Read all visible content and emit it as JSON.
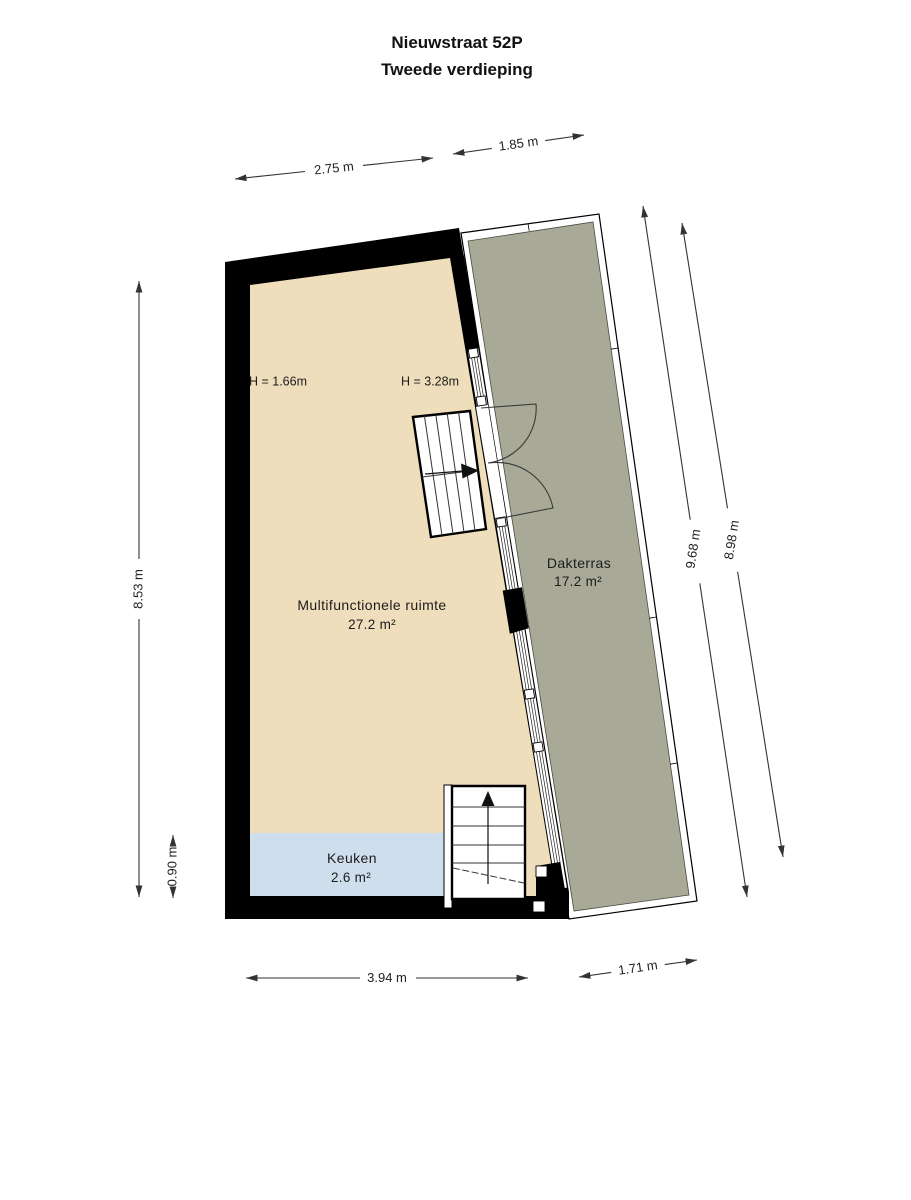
{
  "title": {
    "line1": "Nieuwstraat 52P",
    "line2": "Tweede verdieping"
  },
  "rooms": {
    "multifunctional": {
      "name": "Multifunctionele ruimte",
      "area": "27.2 m²"
    },
    "terrace": {
      "name": "Dakterras",
      "area": "17.2 m²"
    },
    "kitchen": {
      "name": "Keuken",
      "area": "2.6 m²"
    }
  },
  "height_labels": {
    "left": "H = 1.66m",
    "right": "H = 3.28m"
  },
  "dimensions": {
    "top_left": "2.75 m",
    "top_right": "1.85 m",
    "left": "8.53 m",
    "kitchen_depth": "0.90 m",
    "terrace_inner": "9.68 m",
    "terrace_outer": "8.98 m",
    "bottom": "3.94 m",
    "bottom_right": "1.71 m"
  },
  "colors": {
    "background": "#ffffff",
    "wall": "#000000",
    "floor": "#efdebb",
    "kitchen": "#cfdeed",
    "terrace": "#a8a997",
    "dimension": "#333333"
  }
}
